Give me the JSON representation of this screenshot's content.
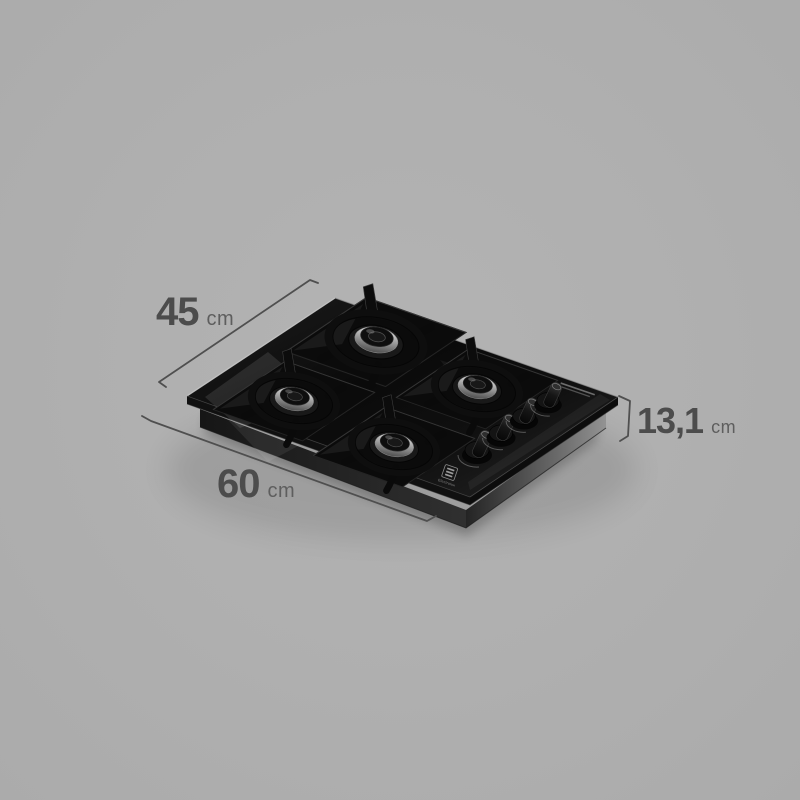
{
  "scene": {
    "background_color": "#b0b0b0",
    "line_color": "#4f4f4f",
    "number_color": "#4c4c4c",
    "unit_color": "#5e5e5e",
    "illustration": "black glass 4-burner gas cooktop, isometric product view"
  },
  "product": {
    "brand": "Electrolux",
    "glass_color": "#0d0d0d"
  },
  "dimensions": {
    "depth": {
      "value": "45",
      "unit": "cm"
    },
    "width": {
      "value": "60",
      "unit": "cm"
    },
    "height": {
      "value": "13,1",
      "unit": "cm"
    }
  }
}
